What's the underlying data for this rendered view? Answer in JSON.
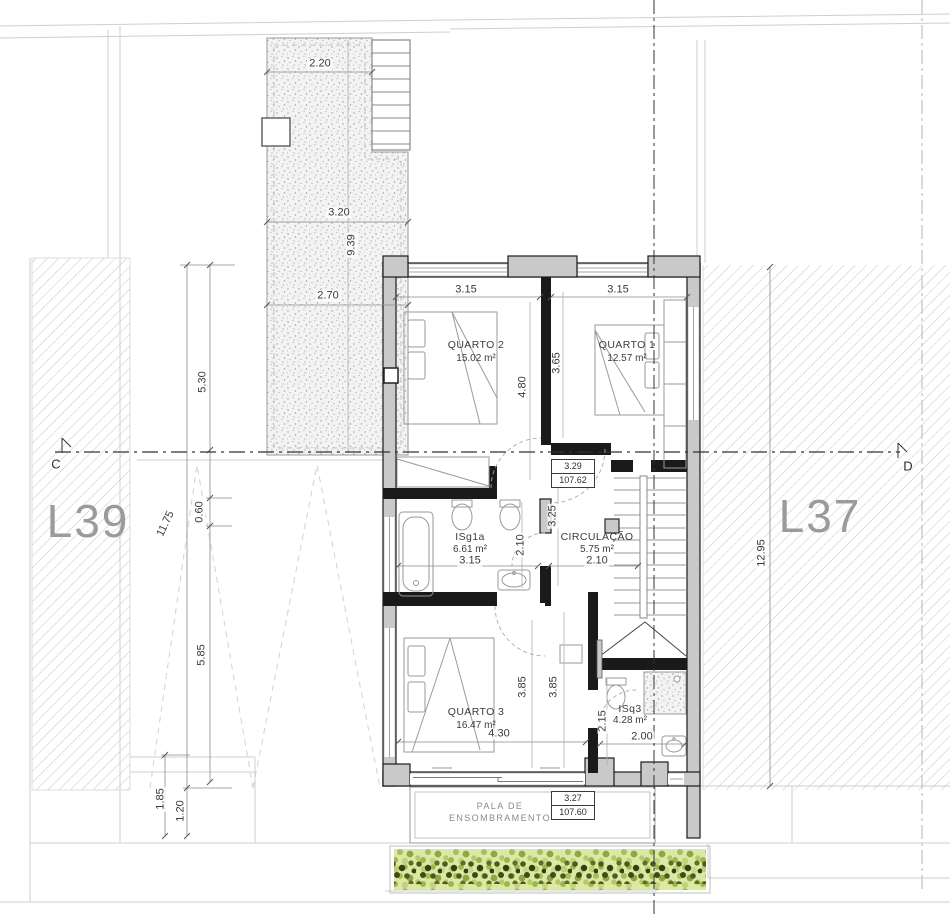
{
  "site": {
    "lot_left": "L39",
    "lot_right": "L37",
    "section_start": "C",
    "section_end": "D"
  },
  "rooms": {
    "quarto2": {
      "name": "QUARTO 2",
      "area": "15.02 m²"
    },
    "quarto1": {
      "name": "QUARTO 1",
      "area": "12.57 m²"
    },
    "isg1a": {
      "name": "ISg1a",
      "area": "6.61 m²"
    },
    "circulacao": {
      "name": "CIRCULAÇÃO",
      "area": "5.75 m²"
    },
    "quarto3": {
      "name": "QUARTO 3",
      "area": "16.47 m²"
    },
    "isq3": {
      "name": "ISq3",
      "area": "4.28 m²"
    }
  },
  "levels": {
    "upper": {
      "height": "3.29",
      "elevation": "107.62"
    },
    "lower": {
      "height": "3.27",
      "elevation": "107.60"
    }
  },
  "canopy": {
    "line1": "PALA DE",
    "line2": "ENSOMBRAMENTO"
  },
  "dimensions": {
    "terrace_top": "2.20",
    "terrace_mid": "3.20",
    "terrace_depth": "9.39",
    "terrace_low": "2.70",
    "left_upper": "5.30",
    "left_total": "11.75",
    "left_offset": "0.60",
    "left_lower": "5.85",
    "left_foot_a": "1.85",
    "left_foot_b": "1.20",
    "right_depth": "12.95",
    "q2_width": "3.15",
    "q1_width": "3.15",
    "q2_depth": "4.80",
    "q1_depth": "3.65",
    "landing_depth": "3.25",
    "bath_depth": "2.10",
    "bath_width": "3.15",
    "circ_width": "2.10",
    "q3_depth_a": "3.85",
    "q3_depth_b": "3.85",
    "q3_width": "4.30",
    "isq3_depth": "2.15",
    "isq3_width": "2.00"
  },
  "colors": {
    "wall_fill": "#c9c9c9",
    "wall_line": "#1a1a1a",
    "hatch": "#c6c6c6",
    "lot_label": "#9b9b9b",
    "hedge_light": "#dde8a4",
    "hedge_dark": "#4c5a1e"
  }
}
